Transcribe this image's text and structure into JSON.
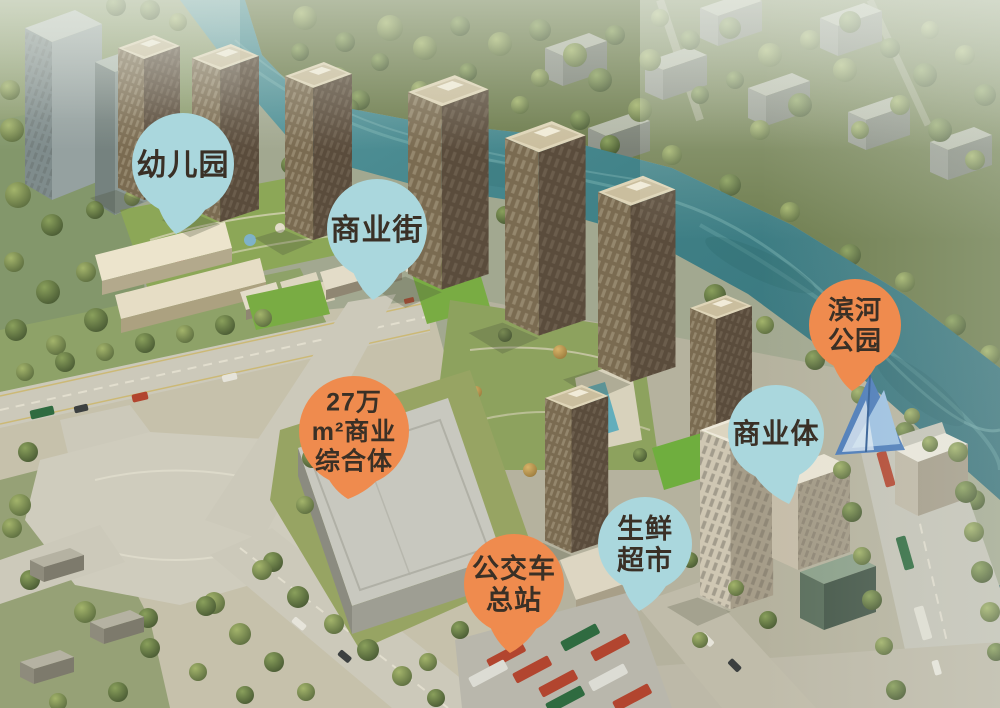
{
  "colors": {
    "pin_blue": "#aad7dd",
    "pin_orange": "#ef8b4e",
    "pin_label_text": "#3a3026"
  },
  "pins": [
    {
      "id": "kindergarten",
      "label": "幼儿园",
      "lines": [
        "幼儿园"
      ],
      "color": "blue",
      "cx": 183,
      "cy": 164,
      "r": 51,
      "tip_x": 176,
      "tip_y": 234,
      "font_size": 30
    },
    {
      "id": "commercial-street",
      "label": "商业街",
      "lines": [
        "商业街"
      ],
      "color": "blue",
      "cx": 377,
      "cy": 229,
      "r": 50,
      "tip_x": 373,
      "tip_y": 300,
      "font_size": 30
    },
    {
      "id": "commercial-complex",
      "label": "27万m²商业综合体",
      "lines": [
        "27万",
        "m²商业",
        "综合体"
      ],
      "color": "orange",
      "cx": 354,
      "cy": 431,
      "r": 55,
      "tip_x": 348,
      "tip_y": 499,
      "font_size": 25
    },
    {
      "id": "bus-terminal",
      "label": "公交车总站",
      "lines": [
        "公交车",
        "总站"
      ],
      "color": "orange",
      "cx": 514,
      "cy": 584,
      "r": 50,
      "tip_x": 510,
      "tip_y": 653,
      "font_size": 27
    },
    {
      "id": "fresh-supermarket",
      "label": "生鲜超市",
      "lines": [
        "生鲜",
        "超市"
      ],
      "color": "blue",
      "cx": 645,
      "cy": 544,
      "r": 47,
      "tip_x": 639,
      "tip_y": 611,
      "font_size": 27
    },
    {
      "id": "commercial-body",
      "label": "商业体",
      "lines": [
        "商业体"
      ],
      "color": "blue",
      "cx": 776,
      "cy": 433,
      "r": 48,
      "tip_x": 789,
      "tip_y": 504,
      "font_size": 28
    },
    {
      "id": "riverside-park",
      "label": "滨河公园",
      "lines": [
        "滨河",
        "公园"
      ],
      "color": "orange",
      "cx": 855,
      "cy": 325,
      "r": 46,
      "tip_x": 852,
      "tip_y": 391,
      "font_size": 26
    }
  ]
}
